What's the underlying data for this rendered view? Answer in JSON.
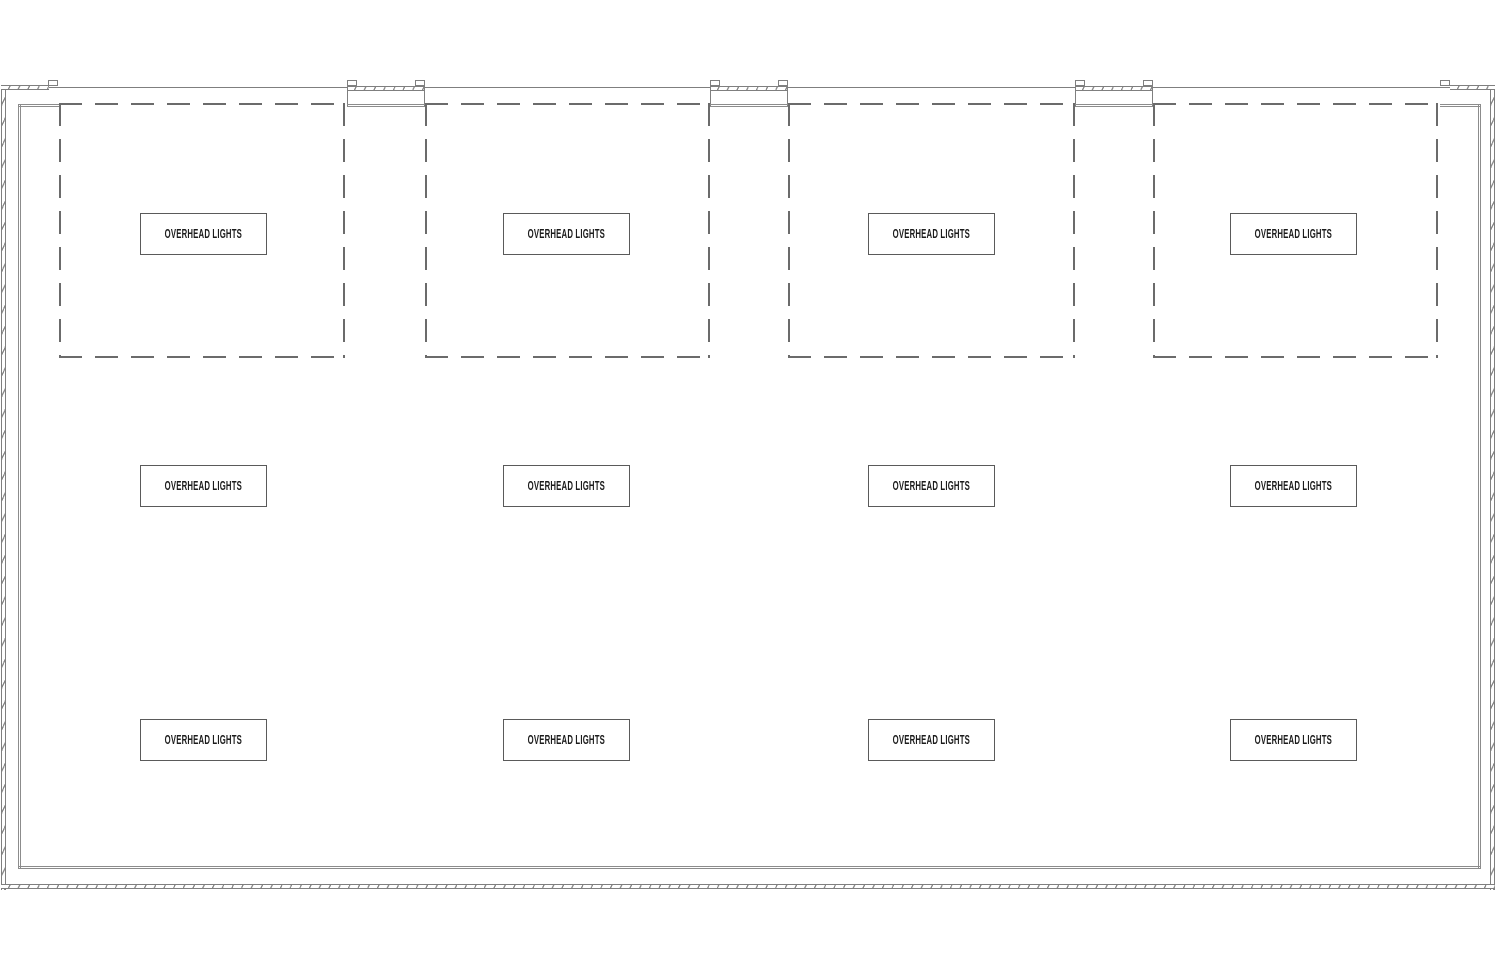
{
  "plan": {
    "background": "#ffffff",
    "wall_line_color": "#7f7f7f",
    "dashed_outline_color": "#6b6b6b",
    "label_text_color": "#1c1c1c",
    "grid": {
      "rows": 3,
      "columns": 4
    },
    "fixture_label": "OVERHEAD LIGHTS",
    "fixtures": [
      {
        "label": "OVERHEAD LIGHTS"
      },
      {
        "label": "OVERHEAD LIGHTS"
      },
      {
        "label": "OVERHEAD LIGHTS"
      },
      {
        "label": "OVERHEAD LIGHTS"
      },
      {
        "label": "OVERHEAD LIGHTS"
      },
      {
        "label": "OVERHEAD LIGHTS"
      },
      {
        "label": "OVERHEAD LIGHTS"
      },
      {
        "label": "OVERHEAD LIGHTS"
      },
      {
        "label": "OVERHEAD LIGHTS"
      },
      {
        "label": "OVERHEAD LIGHTS"
      },
      {
        "label": "OVERHEAD LIGHTS"
      },
      {
        "label": "OVERHEAD LIGHTS"
      }
    ]
  }
}
